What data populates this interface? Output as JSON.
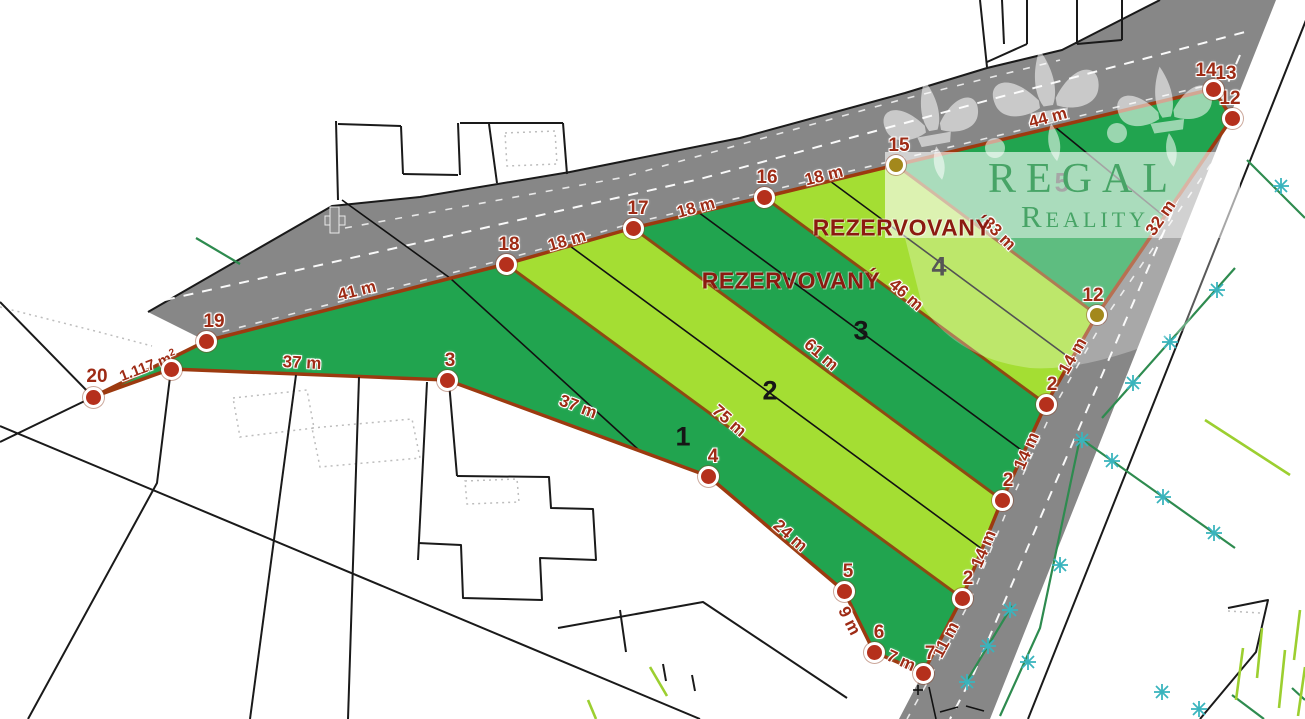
{
  "watermark": {
    "line1": "REGAL",
    "line2": "Reality"
  },
  "texts": {
    "reserved": "REZERVOVANÝ",
    "area_value": "1.117 m",
    "area_sup": "2"
  },
  "colors": {
    "background": "#ffffff",
    "road": "#878787",
    "parcel_dark_green": "#21a44f",
    "parcel_light_green": "#a4de33",
    "boundary_outer": "#9c3a10",
    "boundary_division": "#8f4a12",
    "point_red": "#b5301c",
    "point_olive": "#a3881c",
    "label_red": "#9e2b15",
    "reserved_red": "#8b1a10",
    "watermark_green": "#47a466",
    "tree_teal": "#3ab4bd",
    "tree_green": "#2e8b4f",
    "tree_light_green": "#9ccf30",
    "cadastral_black": "#1a1a1a"
  },
  "measurements": [
    {
      "t": "41 m",
      "x": 357,
      "y": 291,
      "r": -14
    },
    {
      "t": "18 m",
      "x": 567,
      "y": 241,
      "r": -16
    },
    {
      "t": "18 m",
      "x": 696,
      "y": 208,
      "r": -15
    },
    {
      "t": "18 m",
      "x": 824,
      "y": 176,
      "r": -14
    },
    {
      "t": "44 m",
      "x": 1048,
      "y": 118,
      "r": -15
    },
    {
      "t": "32 m",
      "x": 1161,
      "y": 218,
      "r": -55
    },
    {
      "t": "33 m",
      "x": 999,
      "y": 234,
      "r": 45
    },
    {
      "t": "46 m",
      "x": 906,
      "y": 295,
      "r": 41
    },
    {
      "t": "61 m",
      "x": 821,
      "y": 355,
      "r": 41
    },
    {
      "t": "75 m",
      "x": 729,
      "y": 421,
      "r": 41
    },
    {
      "t": "37 m",
      "x": 302,
      "y": 363,
      "r": 3
    },
    {
      "t": "37 m",
      "x": 578,
      "y": 407,
      "r": 21
    },
    {
      "t": "24 m",
      "x": 790,
      "y": 536,
      "r": 41
    },
    {
      "t": "9 m",
      "x": 849,
      "y": 621,
      "r": 63
    },
    {
      "t": "7 m",
      "x": 901,
      "y": 661,
      "r": 24
    },
    {
      "t": "11 m",
      "x": 946,
      "y": 640,
      "r": -62
    },
    {
      "t": "14 m",
      "x": 984,
      "y": 549,
      "r": -67
    },
    {
      "t": "14 m",
      "x": 1027,
      "y": 451,
      "r": -66
    },
    {
      "t": "14 m",
      "x": 1073,
      "y": 356,
      "r": -60
    }
  ],
  "points": [
    {
      "t": "20",
      "x": 93,
      "y": 397,
      "lx": 97,
      "ly": 377,
      "c": "red"
    },
    {
      "t": "",
      "x": 171,
      "y": 369,
      "c": "red"
    },
    {
      "t": "19",
      "x": 206,
      "y": 341,
      "lx": 214,
      "ly": 322,
      "c": "red"
    },
    {
      "t": "18",
      "x": 506,
      "y": 264,
      "lx": 509,
      "ly": 245,
      "c": "red"
    },
    {
      "t": "17",
      "x": 633,
      "y": 228,
      "lx": 638,
      "ly": 209,
      "c": "red"
    },
    {
      "t": "16",
      "x": 764,
      "y": 197,
      "lx": 767,
      "ly": 178,
      "c": "red"
    },
    {
      "t": "15",
      "x": 896,
      "y": 165,
      "lx": 899,
      "ly": 146,
      "c": "olive"
    },
    {
      "t": "14",
      "x": 1213,
      "y": 89,
      "lx": 1206,
      "ly": 71,
      "c": "red"
    },
    {
      "t": "13",
      "label_only": true,
      "lx": 1226,
      "ly": 74
    },
    {
      "t": "12",
      "x": 1232,
      "y": 118,
      "lx": 1230,
      "ly": 99,
      "c": "red"
    },
    {
      "t": "12",
      "x": 1097,
      "y": 315,
      "lx": 1093,
      "ly": 296,
      "c": "olive"
    },
    {
      "t": "2",
      "x": 1046,
      "y": 404,
      "lx": 1052,
      "ly": 385,
      "c": "red"
    },
    {
      "t": "2",
      "x": 1002,
      "y": 500,
      "lx": 1008,
      "ly": 481,
      "c": "red"
    },
    {
      "t": "2",
      "x": 962,
      "y": 598,
      "lx": 968,
      "ly": 579,
      "c": "red"
    },
    {
      "t": "7",
      "x": 923,
      "y": 673,
      "lx": 930,
      "ly": 654,
      "c": "red"
    },
    {
      "t": "6",
      "x": 874,
      "y": 652,
      "lx": 879,
      "ly": 633,
      "c": "red"
    },
    {
      "t": "5",
      "x": 844,
      "y": 591,
      "lx": 848,
      "ly": 572,
      "c": "red"
    },
    {
      "t": "4",
      "x": 708,
      "y": 476,
      "lx": 713,
      "ly": 457,
      "c": "red"
    },
    {
      "t": "3",
      "x": 447,
      "y": 380,
      "lx": 450,
      "ly": 361,
      "c": "red"
    }
  ],
  "parcel_numbers": [
    {
      "t": "1",
      "x": 683,
      "y": 437
    },
    {
      "t": "2",
      "x": 770,
      "y": 391
    },
    {
      "t": "3",
      "x": 861,
      "y": 331
    },
    {
      "t": "4",
      "x": 939,
      "y": 267
    },
    {
      "t": "5",
      "x": 1062,
      "y": 183
    }
  ],
  "reserved_positions": [
    {
      "x": 791,
      "y": 281
    },
    {
      "x": 902,
      "y": 228
    }
  ],
  "area_label": {
    "x": 148,
    "y": 366,
    "r": -21
  }
}
